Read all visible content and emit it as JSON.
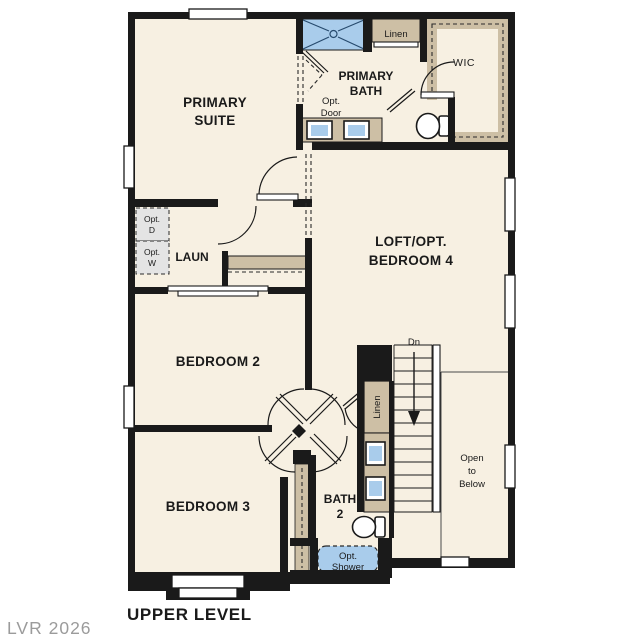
{
  "title": "UPPER LEVEL",
  "watermark": "LVR 2026",
  "colors": {
    "wall": "#1a1a1a",
    "floor": "#f7f0e2",
    "cabinet_tan": "#cdbfa5",
    "fixture_blue": "#a9cceb",
    "fixture_blue_line": "#274a6d",
    "optional_gray": "#e4e4e4",
    "watermark_gray": "#9b9b9b"
  },
  "labels": {
    "primary_suite_1": "PRIMARY",
    "primary_suite_2": "SUITE",
    "primary_bath_1": "PRIMARY",
    "primary_bath_2": "BATH",
    "wic": "WIC",
    "linen_upper": "Linen",
    "opt_door_1": "Opt.",
    "opt_door_2": "Door",
    "loft_1": "LOFT/OPT.",
    "loft_2": "BEDROOM 4",
    "laundry": "LAUN",
    "opt_d_1": "Opt.",
    "opt_d_2": "D",
    "opt_w_1": "Opt.",
    "opt_w_2": "W",
    "bedroom2": "BEDROOM 2",
    "bedroom3": "BEDROOM 3",
    "bath2_1": "BATH",
    "bath2_2": "2",
    "dn": "Dn",
    "linen_stairs": "Linen",
    "open_below_1": "Open",
    "open_below_2": "to",
    "open_below_3": "Below",
    "opt_shower_1": "Opt.",
    "opt_shower_2": "Shower"
  }
}
